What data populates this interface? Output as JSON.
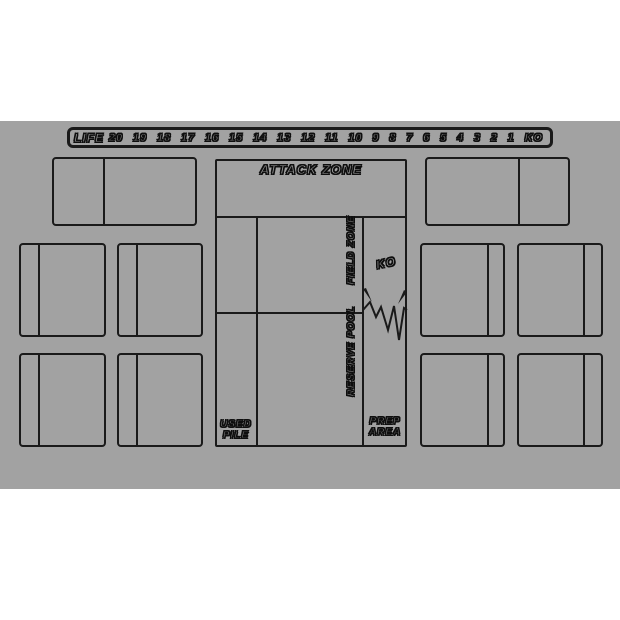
{
  "colors": {
    "mat": "#a2a2a2",
    "line": "#1a1a1a",
    "background": "#ffffff"
  },
  "life_track": {
    "label": "LIFE",
    "values": [
      "20",
      "19",
      "18",
      "17",
      "16",
      "15",
      "14",
      "13",
      "12",
      "11",
      "10",
      "9",
      "8",
      "7",
      "6",
      "5",
      "4",
      "3",
      "2",
      "1",
      "KO"
    ]
  },
  "zones": {
    "attack_zone": "ATTACK ZONE",
    "field_zone": "FIELD ZONE",
    "ko": "KO",
    "reserve_pool": "RESERVE POOL",
    "used_pile": [
      "USED",
      "PILE"
    ],
    "prep_area": [
      "PREP",
      "AREA"
    ]
  }
}
